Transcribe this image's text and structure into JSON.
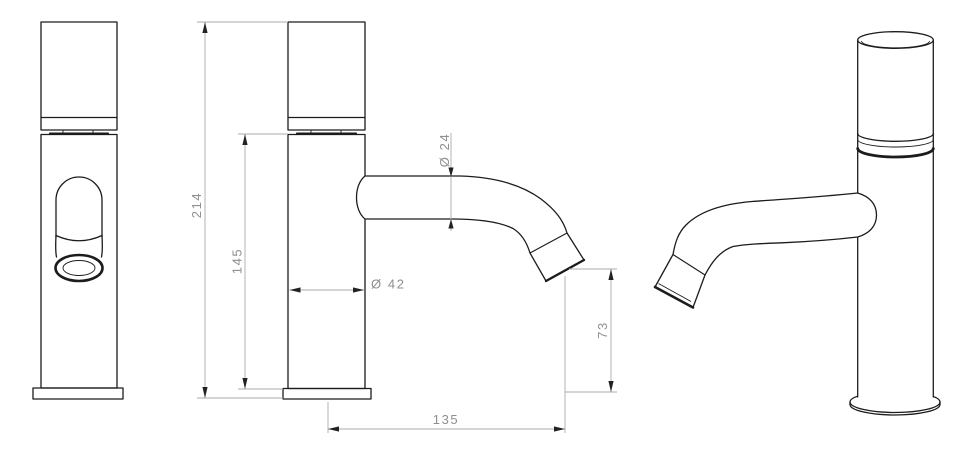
{
  "drawing": {
    "type": "faucet-technical-drawing",
    "dimensions": {
      "total_height": "214",
      "body_height": "145",
      "spout_diameter": "Ø 24",
      "body_diameter": "Ø 42",
      "outlet_height": "73",
      "spout_reach": "135"
    },
    "colors": {
      "object_line": "#1c1c1c",
      "dimension_line": "#ababab",
      "dimension_text": "#8f8f8f",
      "background": "#ffffff"
    }
  }
}
